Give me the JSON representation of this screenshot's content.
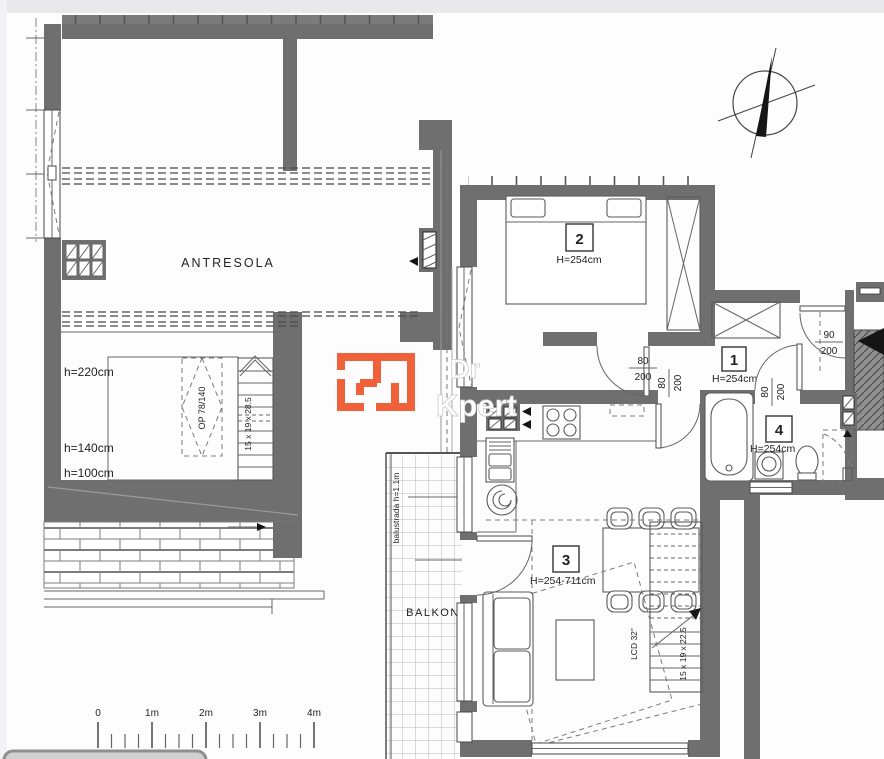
{
  "labels": {
    "antresola": "ANTRESOLA",
    "balkon": "BALKON",
    "balustrade_note": "balustrada h=1.1m",
    "tv": "LCD 32\"",
    "skylight": "OP 78/140"
  },
  "rooms": [
    {
      "number": "2",
      "height": "H=254cm"
    },
    {
      "number": "1",
      "height": "H=254cm"
    },
    {
      "number": "4",
      "height": "H=254cm"
    },
    {
      "number": "3",
      "height": "H=254-711cm"
    }
  ],
  "mezzanine_heights": {
    "h1": "h=220cm",
    "h2": "h=140cm",
    "h3": "h=100cm"
  },
  "stairs": {
    "upper_note": "15 x 19 x 28.5",
    "lower_note": "15 x 19 x 22.5"
  },
  "doors": {
    "bedroom": {
      "w": "80",
      "h": "200"
    },
    "hall_kitchen": {
      "w": "80",
      "h": "200"
    },
    "bathroom": {
      "w": "80",
      "h": "200"
    },
    "entrance": {
      "w": "90",
      "h": "200"
    }
  },
  "scale_bar": {
    "t0": "0",
    "t1": "1m",
    "t2": "2m",
    "t3": "3m",
    "t4": "4m"
  },
  "watermark": {
    "line1": "Dr",
    "line2": "Kpert"
  },
  "colors": {
    "wall": "#6f6f6f",
    "accent_orange": "#f0613a",
    "line": "#3f3f3f"
  }
}
